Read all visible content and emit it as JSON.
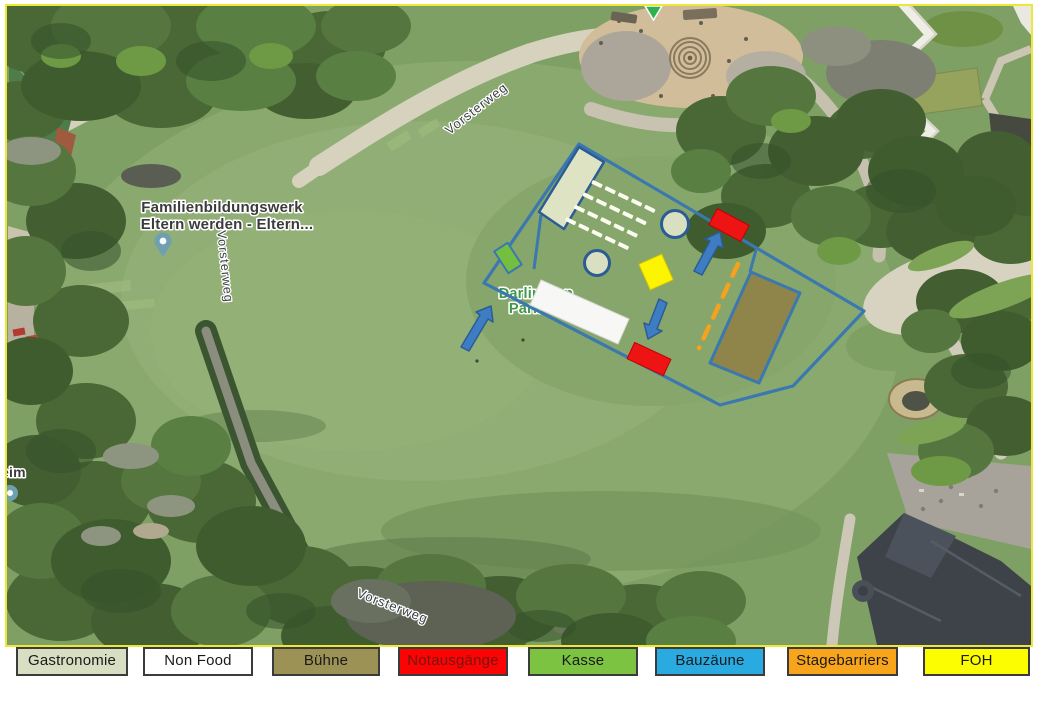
{
  "frame": {
    "map_border_color": "#EDE73A",
    "page_background": "#FFFFFF"
  },
  "map": {
    "labels": {
      "poi_line1": "Familienbildungswerk",
      "poi_line2": "Eltern werden -  Eltern...",
      "street_left": "Vorsterweg",
      "street_top": "Vorsterweg",
      "street_bottom": "Vorsterweg",
      "park_line1": "Darlington",
      "park_line2": "Park",
      "partial_poi_left": "eim"
    },
    "markers": {
      "poi_pin_color": "#6FA0AF",
      "selection_arrow_color": "#2FB24D",
      "poi_label_color": "#3B3B3B",
      "street_label_color": "#3C4043",
      "park_label_color": "#3E9A47"
    }
  },
  "overlay": {
    "colors": {
      "fence": "#3B78B0",
      "shape_border": "#2B5C94",
      "gastronomie": "#DEE3C4",
      "non_food": "#F7F7F5",
      "stage": "#8F854A",
      "emergency": "#EE1414",
      "kasse": "#74BF3F",
      "foh": "#FCF400",
      "stagebarrier": "#F6A21C",
      "arrow": "#3E7DC4",
      "circle_fill": "#D9E0C2"
    },
    "gastro_marks": {
      "rows": 4,
      "cols": 5,
      "color": "#FCFBF0"
    }
  },
  "legend": {
    "items": [
      {
        "label": "Gastronomie",
        "fill": "#D8DEC1",
        "text_color": "#1A1A1A"
      },
      {
        "label": "Non Food",
        "fill": "#FFFFFF",
        "text_color": "#1A1A1A"
      },
      {
        "label": "Bühne",
        "fill": "#9D9255",
        "text_color": "#1A1A1A"
      },
      {
        "label": "Notausgänge",
        "fill": "#FB0404",
        "text_color": "#7A1410"
      },
      {
        "label": "Kasse",
        "fill": "#7CC342",
        "text_color": "#1A1A1A"
      },
      {
        "label": "Bauzäune",
        "fill": "#29ABE2",
        "text_color": "#1A1A1A"
      },
      {
        "label": "Stagebarriers",
        "fill": "#F8A51B",
        "text_color": "#1A1A1A"
      },
      {
        "label": "FOH",
        "fill": "#FDFD02",
        "text_color": "#1A1A1A"
      }
    ]
  }
}
